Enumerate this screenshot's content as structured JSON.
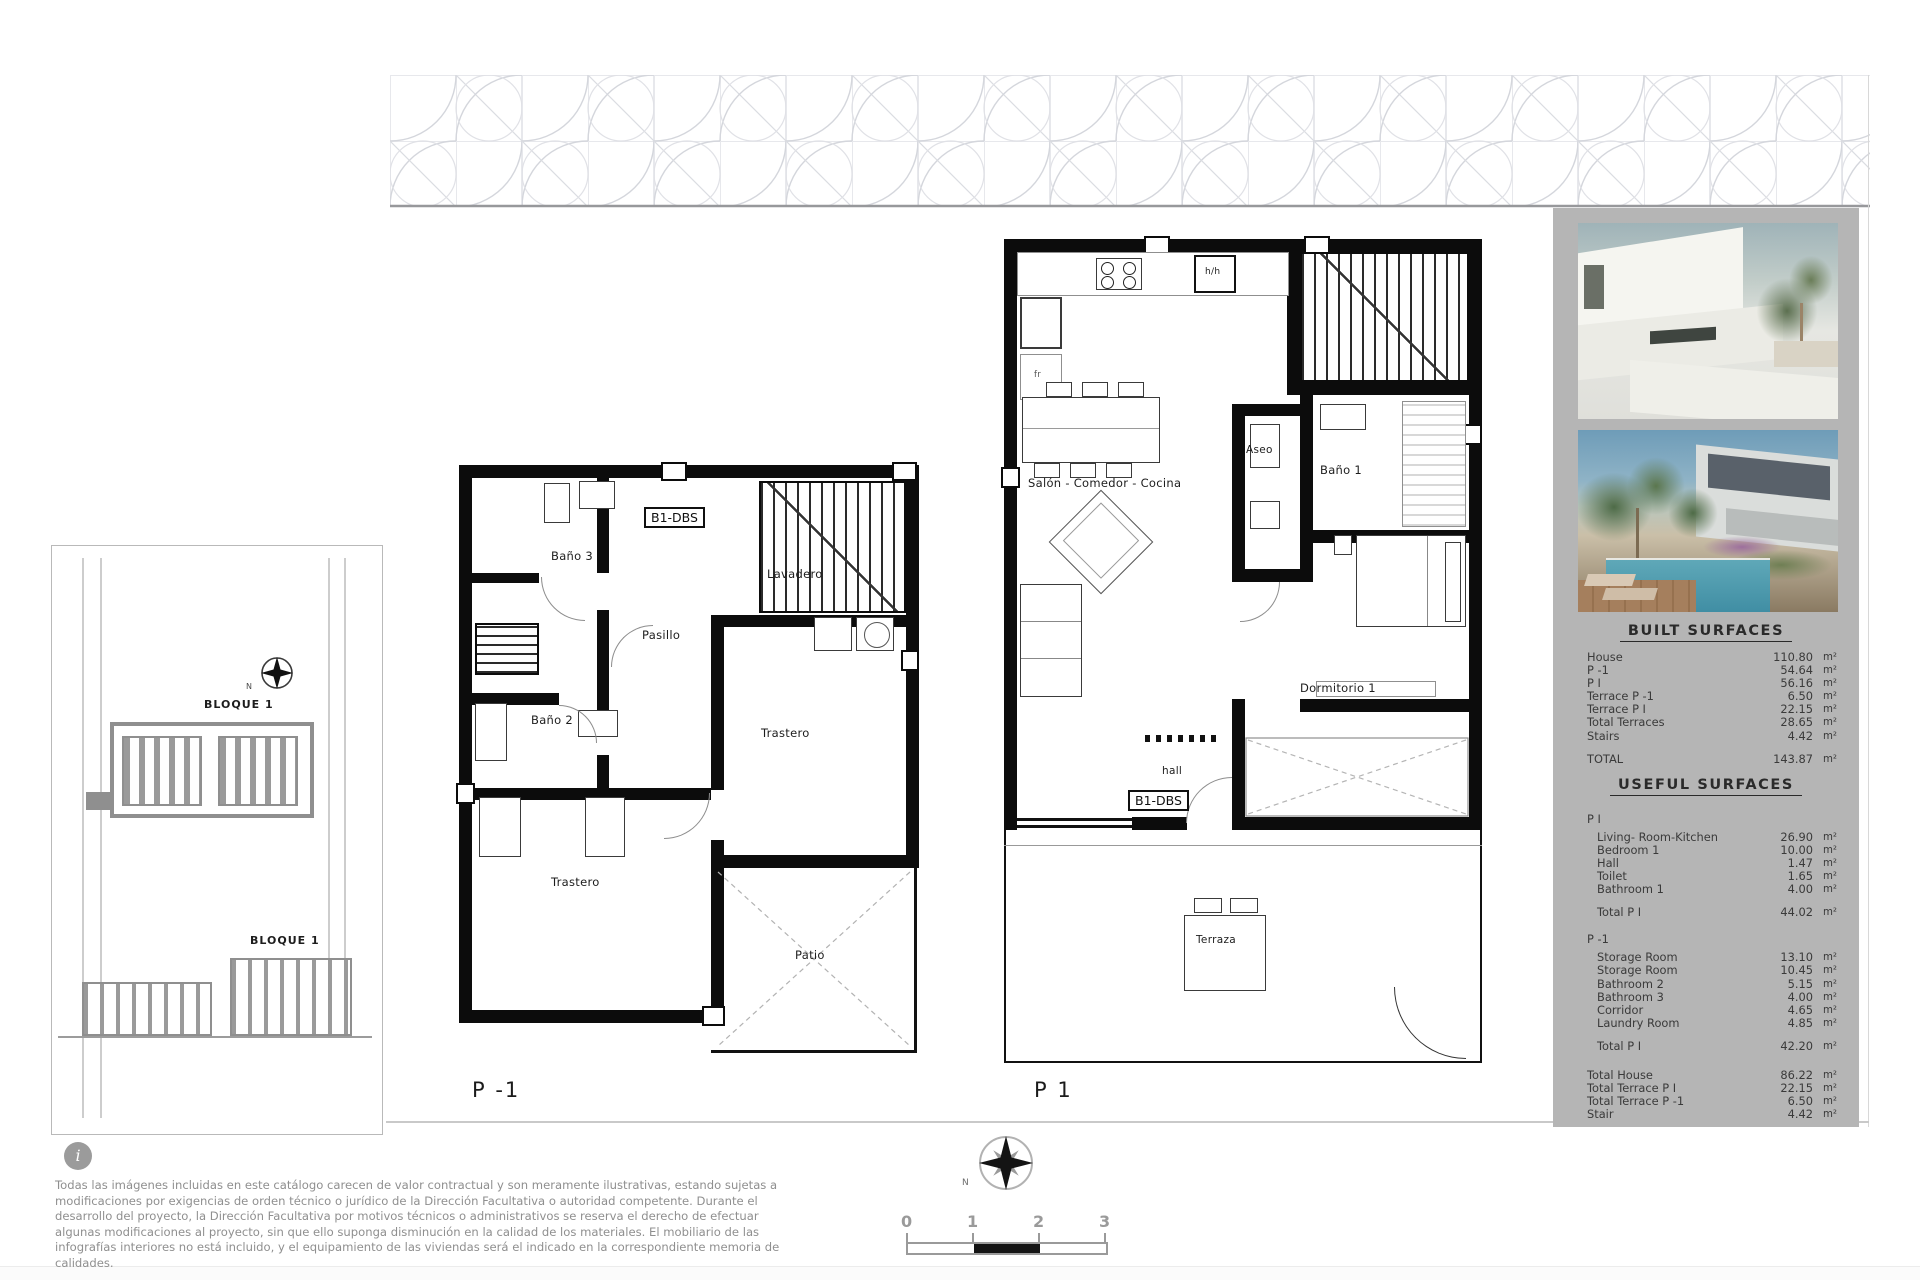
{
  "units": {
    "area": "m²"
  },
  "sidebar": {
    "photos": [
      {
        "name": "exterior-render"
      },
      {
        "name": "pool-render"
      }
    ],
    "built_surfaces": {
      "title": "BUILT SURFACES",
      "rows": [
        {
          "label": "House",
          "value": "110.80"
        },
        {
          "label": "P -1",
          "value": "54.64"
        },
        {
          "label": "P I",
          "value": "56.16"
        },
        {
          "label": "Terrace P -1",
          "value": "6.50"
        },
        {
          "label": "Terrace P I",
          "value": "22.15"
        },
        {
          "label": "Total Terraces",
          "value": "28.65"
        },
        {
          "label": "Stairs",
          "value": "4.42"
        }
      ],
      "total": {
        "label": "TOTAL",
        "value": "143.87"
      }
    },
    "useful_surfaces": {
      "title": "USEFUL SURFACES",
      "sections": [
        {
          "heading": "P I",
          "rows": [
            {
              "label": "Living- Room-Kitchen",
              "value": "26.90"
            },
            {
              "label": "Bedroom 1",
              "value": "10.00"
            },
            {
              "label": "Hall",
              "value": "1.47"
            },
            {
              "label": "Toilet",
              "value": "1.65"
            },
            {
              "label": "Bathroom 1",
              "value": "4.00"
            }
          ],
          "total": {
            "label": "Total P I",
            "value": "44.02"
          }
        },
        {
          "heading": "P -1",
          "rows": [
            {
              "label": "Storage Room",
              "value": "13.10"
            },
            {
              "label": "Storage Room",
              "value": "10.45"
            },
            {
              "label": "Bathroom 2",
              "value": "5.15"
            },
            {
              "label": "Bathroom 3",
              "value": "4.00"
            },
            {
              "label": "Corridor",
              "value": "4.65"
            },
            {
              "label": "Laundry Room",
              "value": "4.85"
            }
          ],
          "total": {
            "label": "Total P I",
            "value": "42.20"
          }
        }
      ],
      "summary": [
        {
          "label": "Total House",
          "value": "86.22"
        },
        {
          "label": "Total Terrace P I",
          "value": "22.15"
        },
        {
          "label": "Total Terrace P -1",
          "value": "6.50"
        },
        {
          "label": "Stair",
          "value": "4.42"
        }
      ]
    }
  },
  "site_plan": {
    "block_label_top": "BLOQUE 1",
    "block_label_bottom": "BLOQUE 1",
    "north_label": "N"
  },
  "plan_basement": {
    "floor_label": "P -1",
    "unit_tag": "B1-DBS",
    "rooms": {
      "bano3": "Baño 3",
      "lavadero": "Lavadero",
      "pasillo": "Pasillo",
      "bano2": "Baño 2",
      "trastero_right": "Trastero",
      "trastero_left": "Trastero",
      "patio": "Patio"
    }
  },
  "plan_first": {
    "floor_label": "P 1",
    "unit_tag": "B1-DBS",
    "appliance_label": "h/h",
    "fridge_label": "fr",
    "rooms": {
      "salon": "Salón - Comedor - Cocina",
      "aseo": "Aseo",
      "bano1": "Baño 1",
      "dormitorio1": "Dormitorio 1",
      "hall": "hall",
      "terraza": "Terraza"
    }
  },
  "footer": {
    "info_icon": "i",
    "disclaimer": "Todas las imágenes incluidas en este catálogo carecen de valor contractual y son meramente ilustrativas, estando sujetas a modificaciones por exigencias de orden técnico o jurídico de la Dirección Facultativa o autoridad competente. Durante el desarrollo del proyecto, la Dirección Facultativa por motivos técnicos o administrativos se reserva el derecho de efectuar algunas modificaciones al proyecto, sin que ello suponga disminución en la calidad de los materiales. El mobiliario de las infografías interiores no está incluido, y el equipamiento de las viviendas será el indicado en la correspondiente memoria de calidades.",
    "compass_label": "N",
    "scale": {
      "ticks": [
        "0",
        "1",
        "2",
        "3"
      ]
    }
  },
  "colors": {
    "sidebar_bg": "#b5b5b5",
    "wall": "#0c0c0c",
    "muted_text": "#8f8f8f",
    "frieze_line": "#d4d6dc"
  }
}
